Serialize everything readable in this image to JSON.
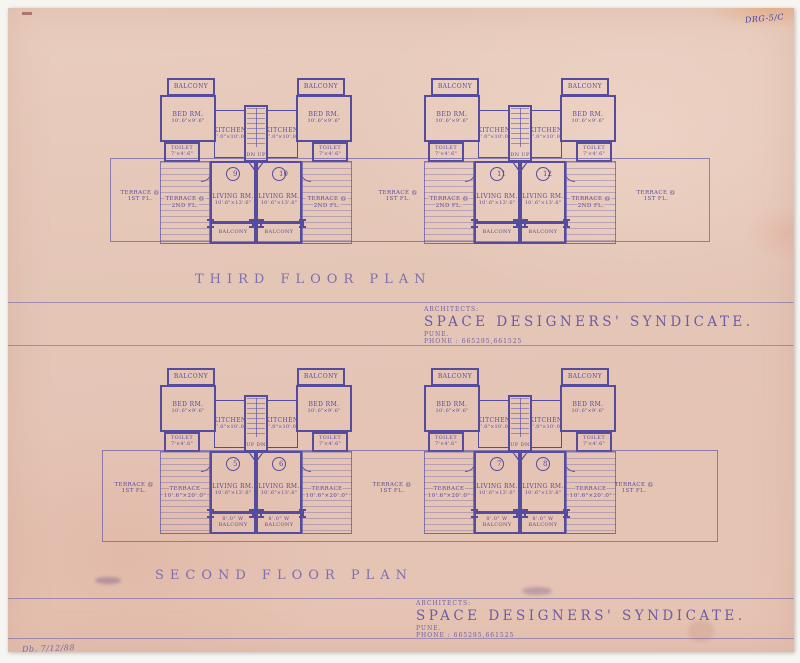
{
  "annotations": {
    "top_right": "DRG-5/C",
    "bottom_left": "Db.  7/12/88"
  },
  "architects": {
    "label": "ARCHITECTS:",
    "firm": "SPACE DESIGNERS' SYNDICATE.",
    "city": "PUNE.",
    "phone": "PHONE : 665295,661525"
  },
  "rooms": {
    "balcony": "BALCONY",
    "bed_name": "BED RM.",
    "bed_dim": "10'.6\"×9'.6\"",
    "kitchen_name": "KITCHEN",
    "kitchen_dim": "7'.0\"×10'.0\"",
    "toilet_name": "TOILET",
    "toilet_dim": "7'×4'.6\"",
    "living_name": "LIVING RM.",
    "living_dim": "10'.6\"×13'.6\""
  },
  "plans": [
    {
      "title": "THIRD FLOOR PLAN",
      "stair": "DN UP",
      "terrace_inner_l1": "TERRACE @",
      "terrace_inner_l2": "2ND FL.",
      "terrace_outer_l1": "TERRACE @",
      "terrace_outer_l2": "1ST FL.",
      "balcony_b_l1": "",
      "balcony_b_l2": "BALCONY",
      "buildings": [
        {
          "units": [
            "9",
            "10"
          ]
        },
        {
          "units": [
            "11",
            "12"
          ]
        }
      ]
    },
    {
      "title": "SECOND FLOOR PLAN",
      "stair": "UP DN",
      "terrace_inner_l1": "TERRACE",
      "terrace_inner_l2": "10'.6\"×20'.0\"",
      "terrace_outer_l1": "TERRACE @",
      "terrace_outer_l2": "1ST FL.",
      "balcony_b_l1": "8'.0\" W",
      "balcony_b_l2": "BALCONY",
      "buildings": [
        {
          "units": [
            "5",
            "6"
          ]
        },
        {
          "units": [
            "7",
            "8"
          ]
        }
      ]
    }
  ],
  "colors": {
    "paper": "#e5c6b7",
    "ink": "#5f55a6",
    "annotation": "#4244ad"
  }
}
